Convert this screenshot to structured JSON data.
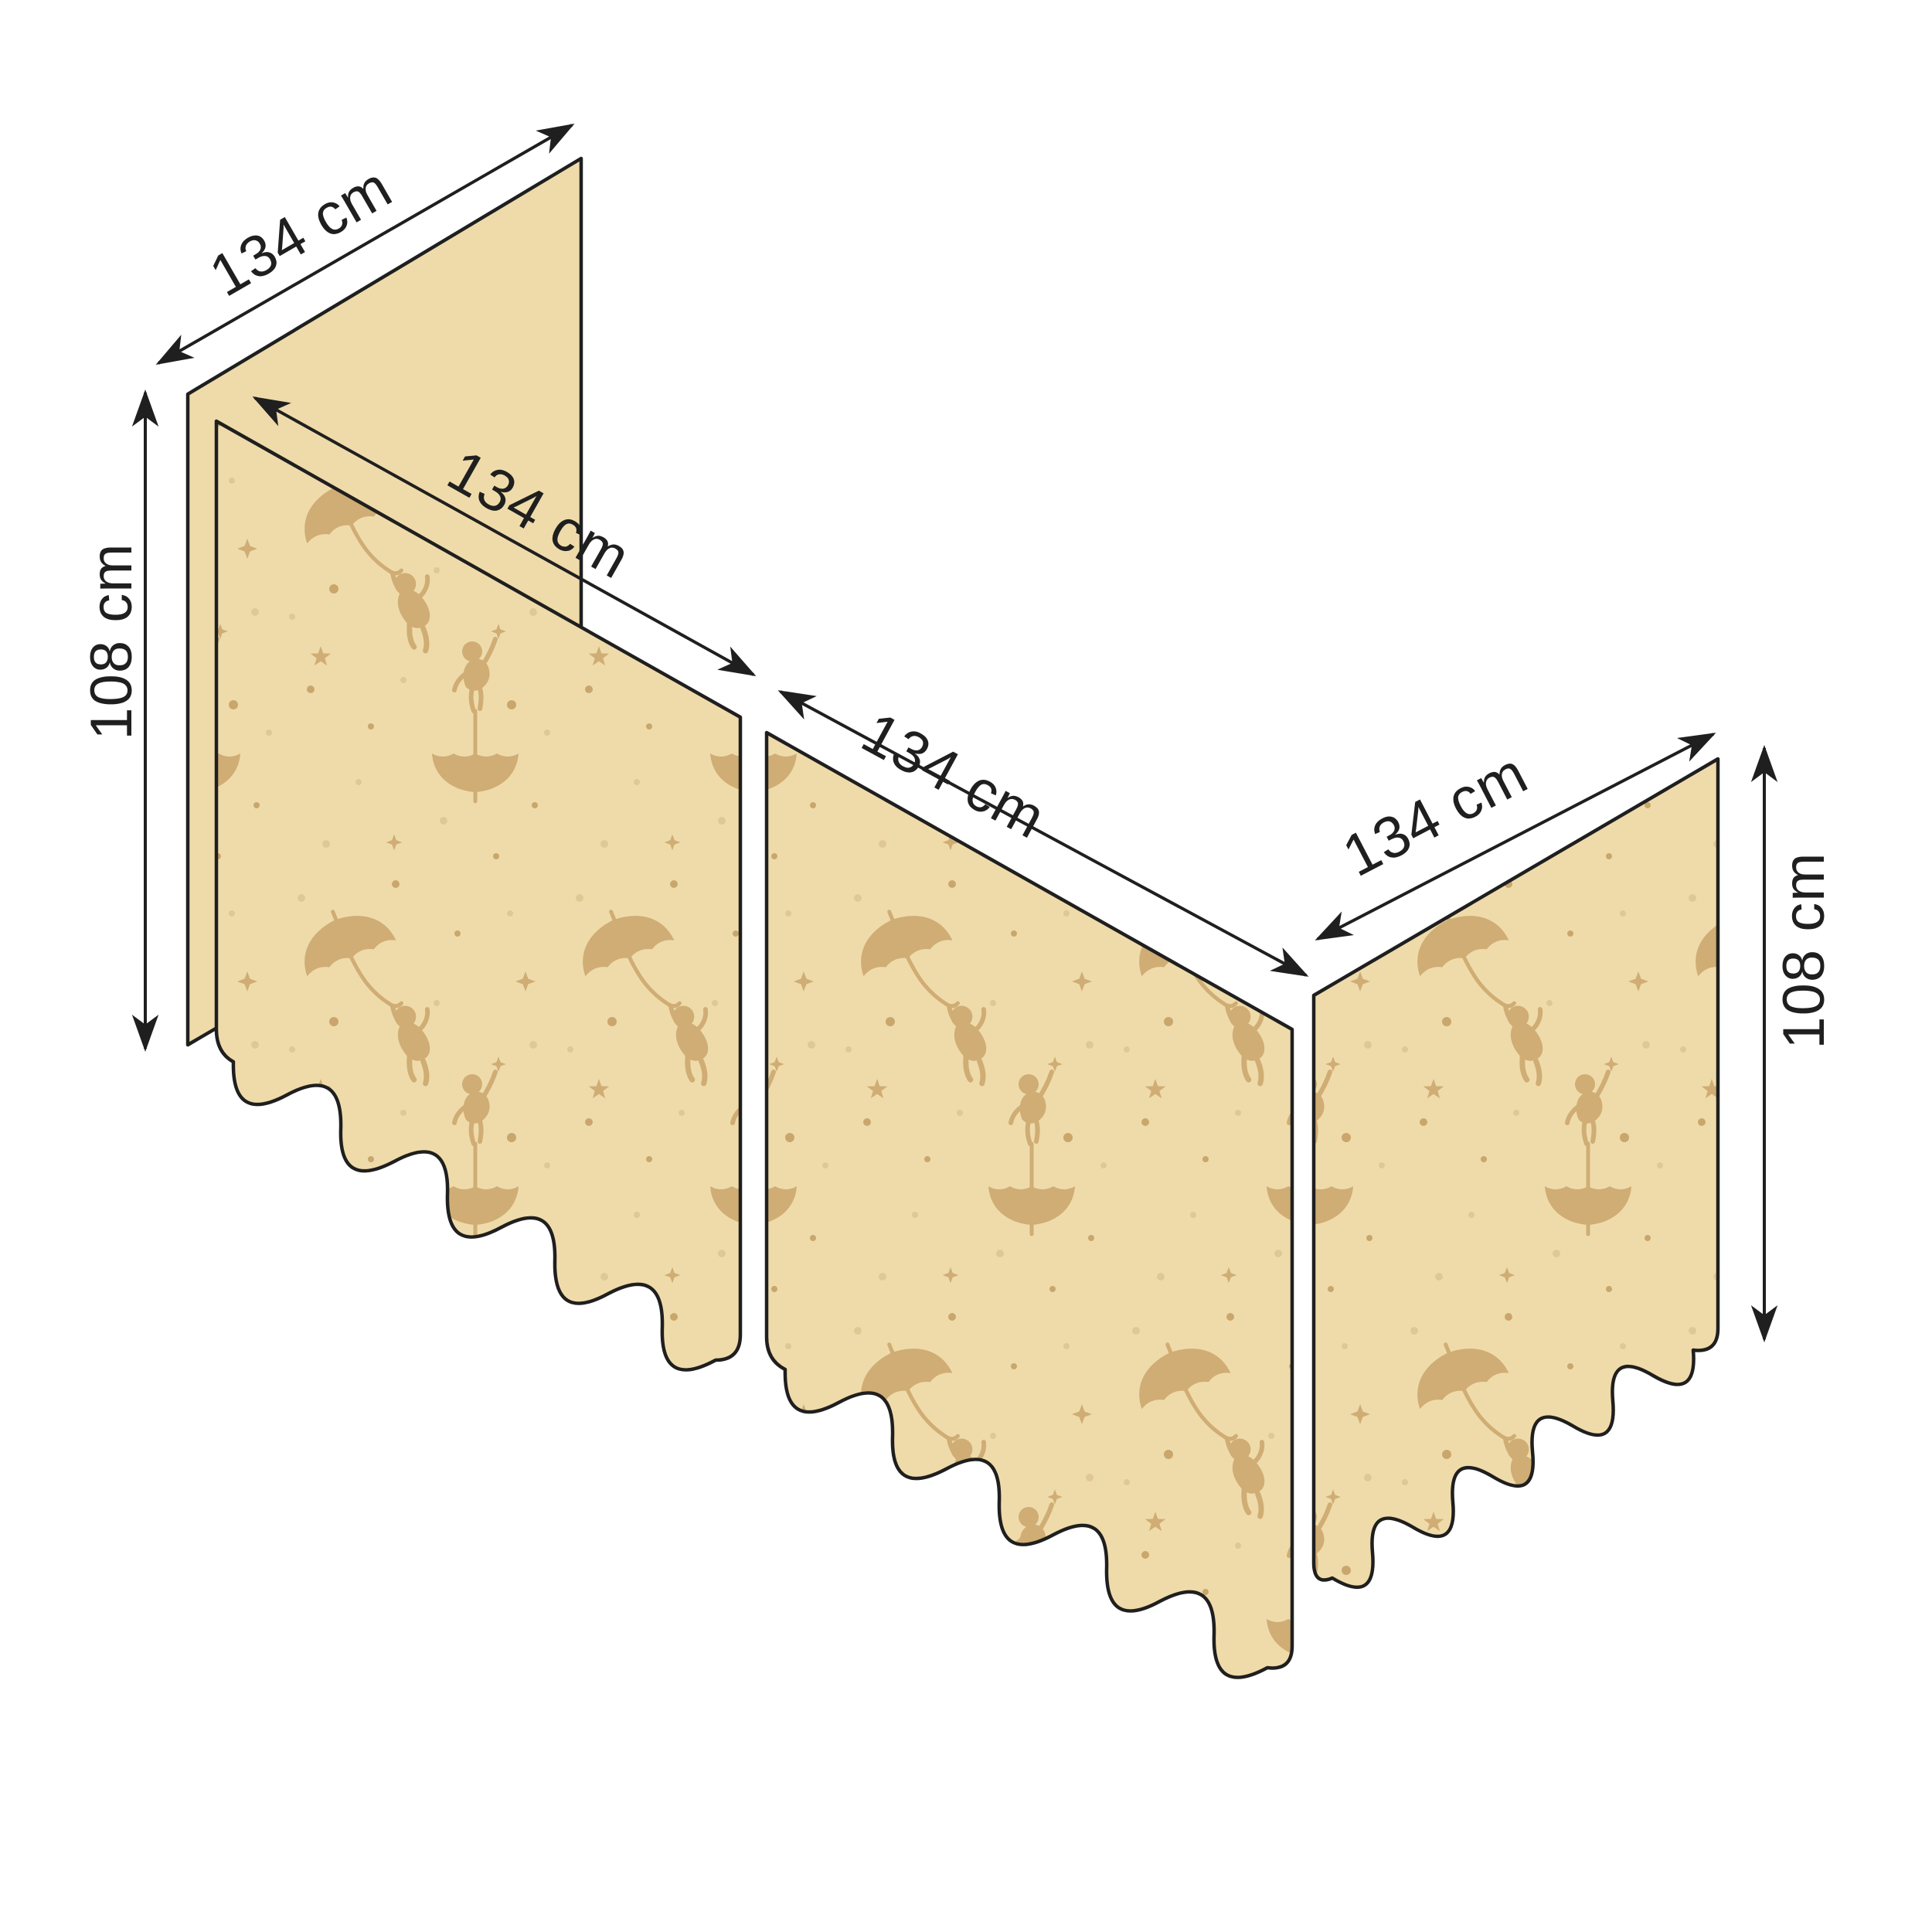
{
  "diagram": {
    "type": "product-dimension-diagram",
    "subject": "bed curtain set shown in perspective: one plain back panel and three patterned panels with scalloped bottom edges",
    "panels": [
      {
        "name": "back panel (plain)",
        "width_label": "134 cm",
        "height_label": "108 cm",
        "patterned": false
      },
      {
        "name": "front left panel",
        "width_label": "134 cm",
        "patterned": true
      },
      {
        "name": "front middle panel",
        "width_label": "134 cm",
        "patterned": true
      },
      {
        "name": "right side panel",
        "width_label": "134 cm",
        "height_label": "108 cm",
        "patterned": true
      }
    ]
  },
  "labels": {
    "back_width": "134 cm",
    "left_height": "108 cm",
    "front_left_width": "134 cm",
    "front_middle_width": "134 cm",
    "right_width": "134 cm",
    "right_height": "108 cm"
  },
  "pattern": {
    "motifs": [
      "child-hanging-from-umbrella",
      "child-standing-on-upside-down-umbrella",
      "stars",
      "dots"
    ]
  },
  "colors": {
    "background": "#ffffff",
    "fabric": "#efdbaa",
    "motif": "#cfad74",
    "dot_light": "#dfc894",
    "dot_dark": "#c9a76c",
    "ink": "#1f1f1f"
  }
}
